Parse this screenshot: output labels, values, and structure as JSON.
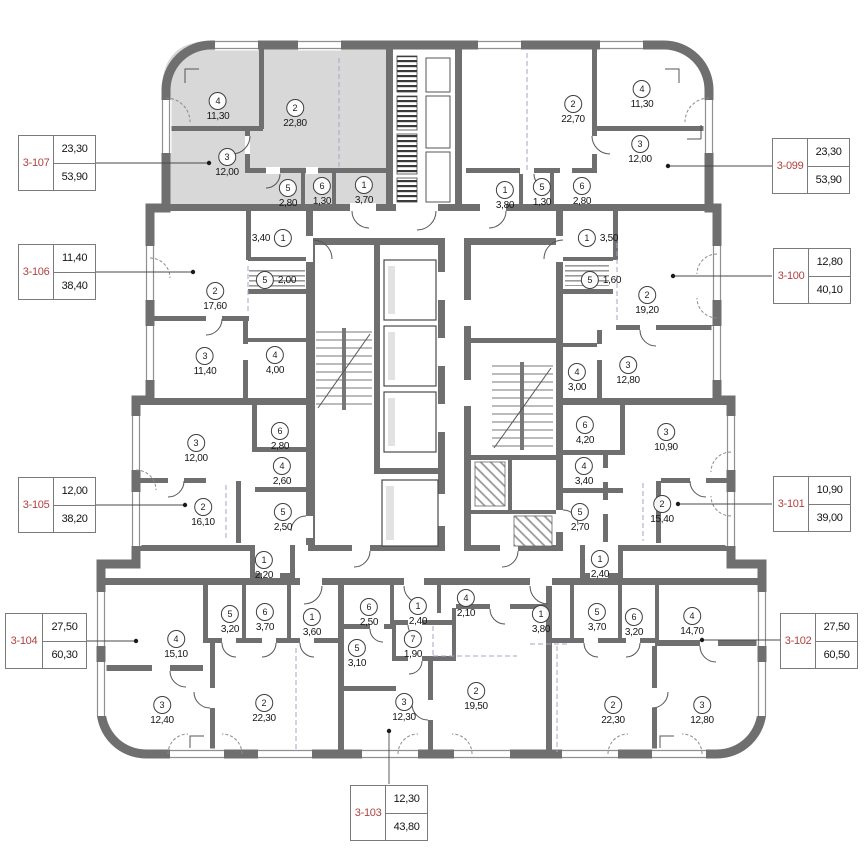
{
  "legend": {
    "units": [
      {
        "id": "3-107",
        "area1": "23,30",
        "area2": "53,90"
      },
      {
        "id": "3-106",
        "area1": "11,40",
        "area2": "38,40"
      },
      {
        "id": "3-105",
        "area1": "12,00",
        "area2": "38,20"
      },
      {
        "id": "3-104",
        "area1": "27,50",
        "area2": "60,30"
      },
      {
        "id": "3-103",
        "area1": "12,30",
        "area2": "43,80"
      },
      {
        "id": "3-102",
        "area1": "27,50",
        "area2": "60,50"
      },
      {
        "id": "3-101",
        "area1": "10,90",
        "area2": "39,00"
      },
      {
        "id": "3-100",
        "area1": "12,80",
        "area2": "40,10"
      },
      {
        "id": "3-099",
        "area1": "23,30",
        "area2": "53,90"
      }
    ]
  },
  "apartments": {
    "a107": {
      "rooms": [
        {
          "n": "4",
          "a": "11,30"
        },
        {
          "n": "2",
          "a": "22,80"
        },
        {
          "n": "3",
          "a": "12,00"
        },
        {
          "n": "5",
          "a": "2,80"
        },
        {
          "n": "6",
          "a": "1,30"
        },
        {
          "n": "1",
          "a": "3,70"
        }
      ]
    },
    "a099": {
      "rooms": [
        {
          "n": "2",
          "a": "22,70"
        },
        {
          "n": "4",
          "a": "11,30"
        },
        {
          "n": "3",
          "a": "12,00"
        },
        {
          "n": "1",
          "a": "3,80"
        },
        {
          "n": "5",
          "a": "1,30"
        },
        {
          "n": "6",
          "a": "2,80"
        }
      ]
    },
    "a106": {
      "rooms": [
        {
          "n": "1",
          "a": "3,40"
        },
        {
          "n": "5",
          "a": "2,00"
        },
        {
          "n": "2",
          "a": "17,60"
        },
        {
          "n": "3",
          "a": "11,40"
        },
        {
          "n": "4",
          "a": "4,00"
        }
      ]
    },
    "a100": {
      "rooms": [
        {
          "n": "1",
          "a": "3,50"
        },
        {
          "n": "5",
          "a": "1,60"
        },
        {
          "n": "2",
          "a": "19,20"
        },
        {
          "n": "3",
          "a": "12,80"
        },
        {
          "n": "4",
          "a": "3,00"
        }
      ]
    },
    "a105": {
      "rooms": [
        {
          "n": "3",
          "a": "12,00"
        },
        {
          "n": "6",
          "a": "2,80"
        },
        {
          "n": "4",
          "a": "2,60"
        },
        {
          "n": "2",
          "a": "16,10"
        },
        {
          "n": "5",
          "a": "2,50"
        },
        {
          "n": "1",
          "a": "2,20"
        }
      ]
    },
    "a101": {
      "rooms": [
        {
          "n": "6",
          "a": "4,20"
        },
        {
          "n": "3",
          "a": "10,90"
        },
        {
          "n": "4",
          "a": "3,40"
        },
        {
          "n": "2",
          "a": "15,40"
        },
        {
          "n": "5",
          "a": "2,70"
        },
        {
          "n": "1",
          "a": "2,40"
        }
      ]
    },
    "a104": {
      "rooms": [
        {
          "n": "5",
          "a": "3,20"
        },
        {
          "n": "6",
          "a": "3,70"
        },
        {
          "n": "1",
          "a": "3,60"
        },
        {
          "n": "4",
          "a": "15,10"
        },
        {
          "n": "3",
          "a": "12,40"
        },
        {
          "n": "2",
          "a": "22,30"
        }
      ]
    },
    "a103": {
      "rooms": [
        {
          "n": "6",
          "a": "2,50"
        },
        {
          "n": "1",
          "a": "2,40"
        },
        {
          "n": "4",
          "a": "2,10"
        },
        {
          "n": "7",
          "a": "1,90"
        },
        {
          "n": "5",
          "a": "3,10"
        },
        {
          "n": "3",
          "a": "12,30"
        },
        {
          "n": "2",
          "a": "19,50"
        }
      ]
    },
    "a102": {
      "rooms": [
        {
          "n": "1",
          "a": "3,80"
        },
        {
          "n": "5",
          "a": "3,70"
        },
        {
          "n": "6",
          "a": "3,20"
        },
        {
          "n": "4",
          "a": "14,70"
        },
        {
          "n": "2",
          "a": "22,30"
        },
        {
          "n": "3",
          "a": "12,80"
        }
      ]
    }
  },
  "colors": {
    "wall": "#6f6f6f",
    "highlight_unit": "#d8d8d8",
    "unit_label_red": "#b0413f"
  }
}
